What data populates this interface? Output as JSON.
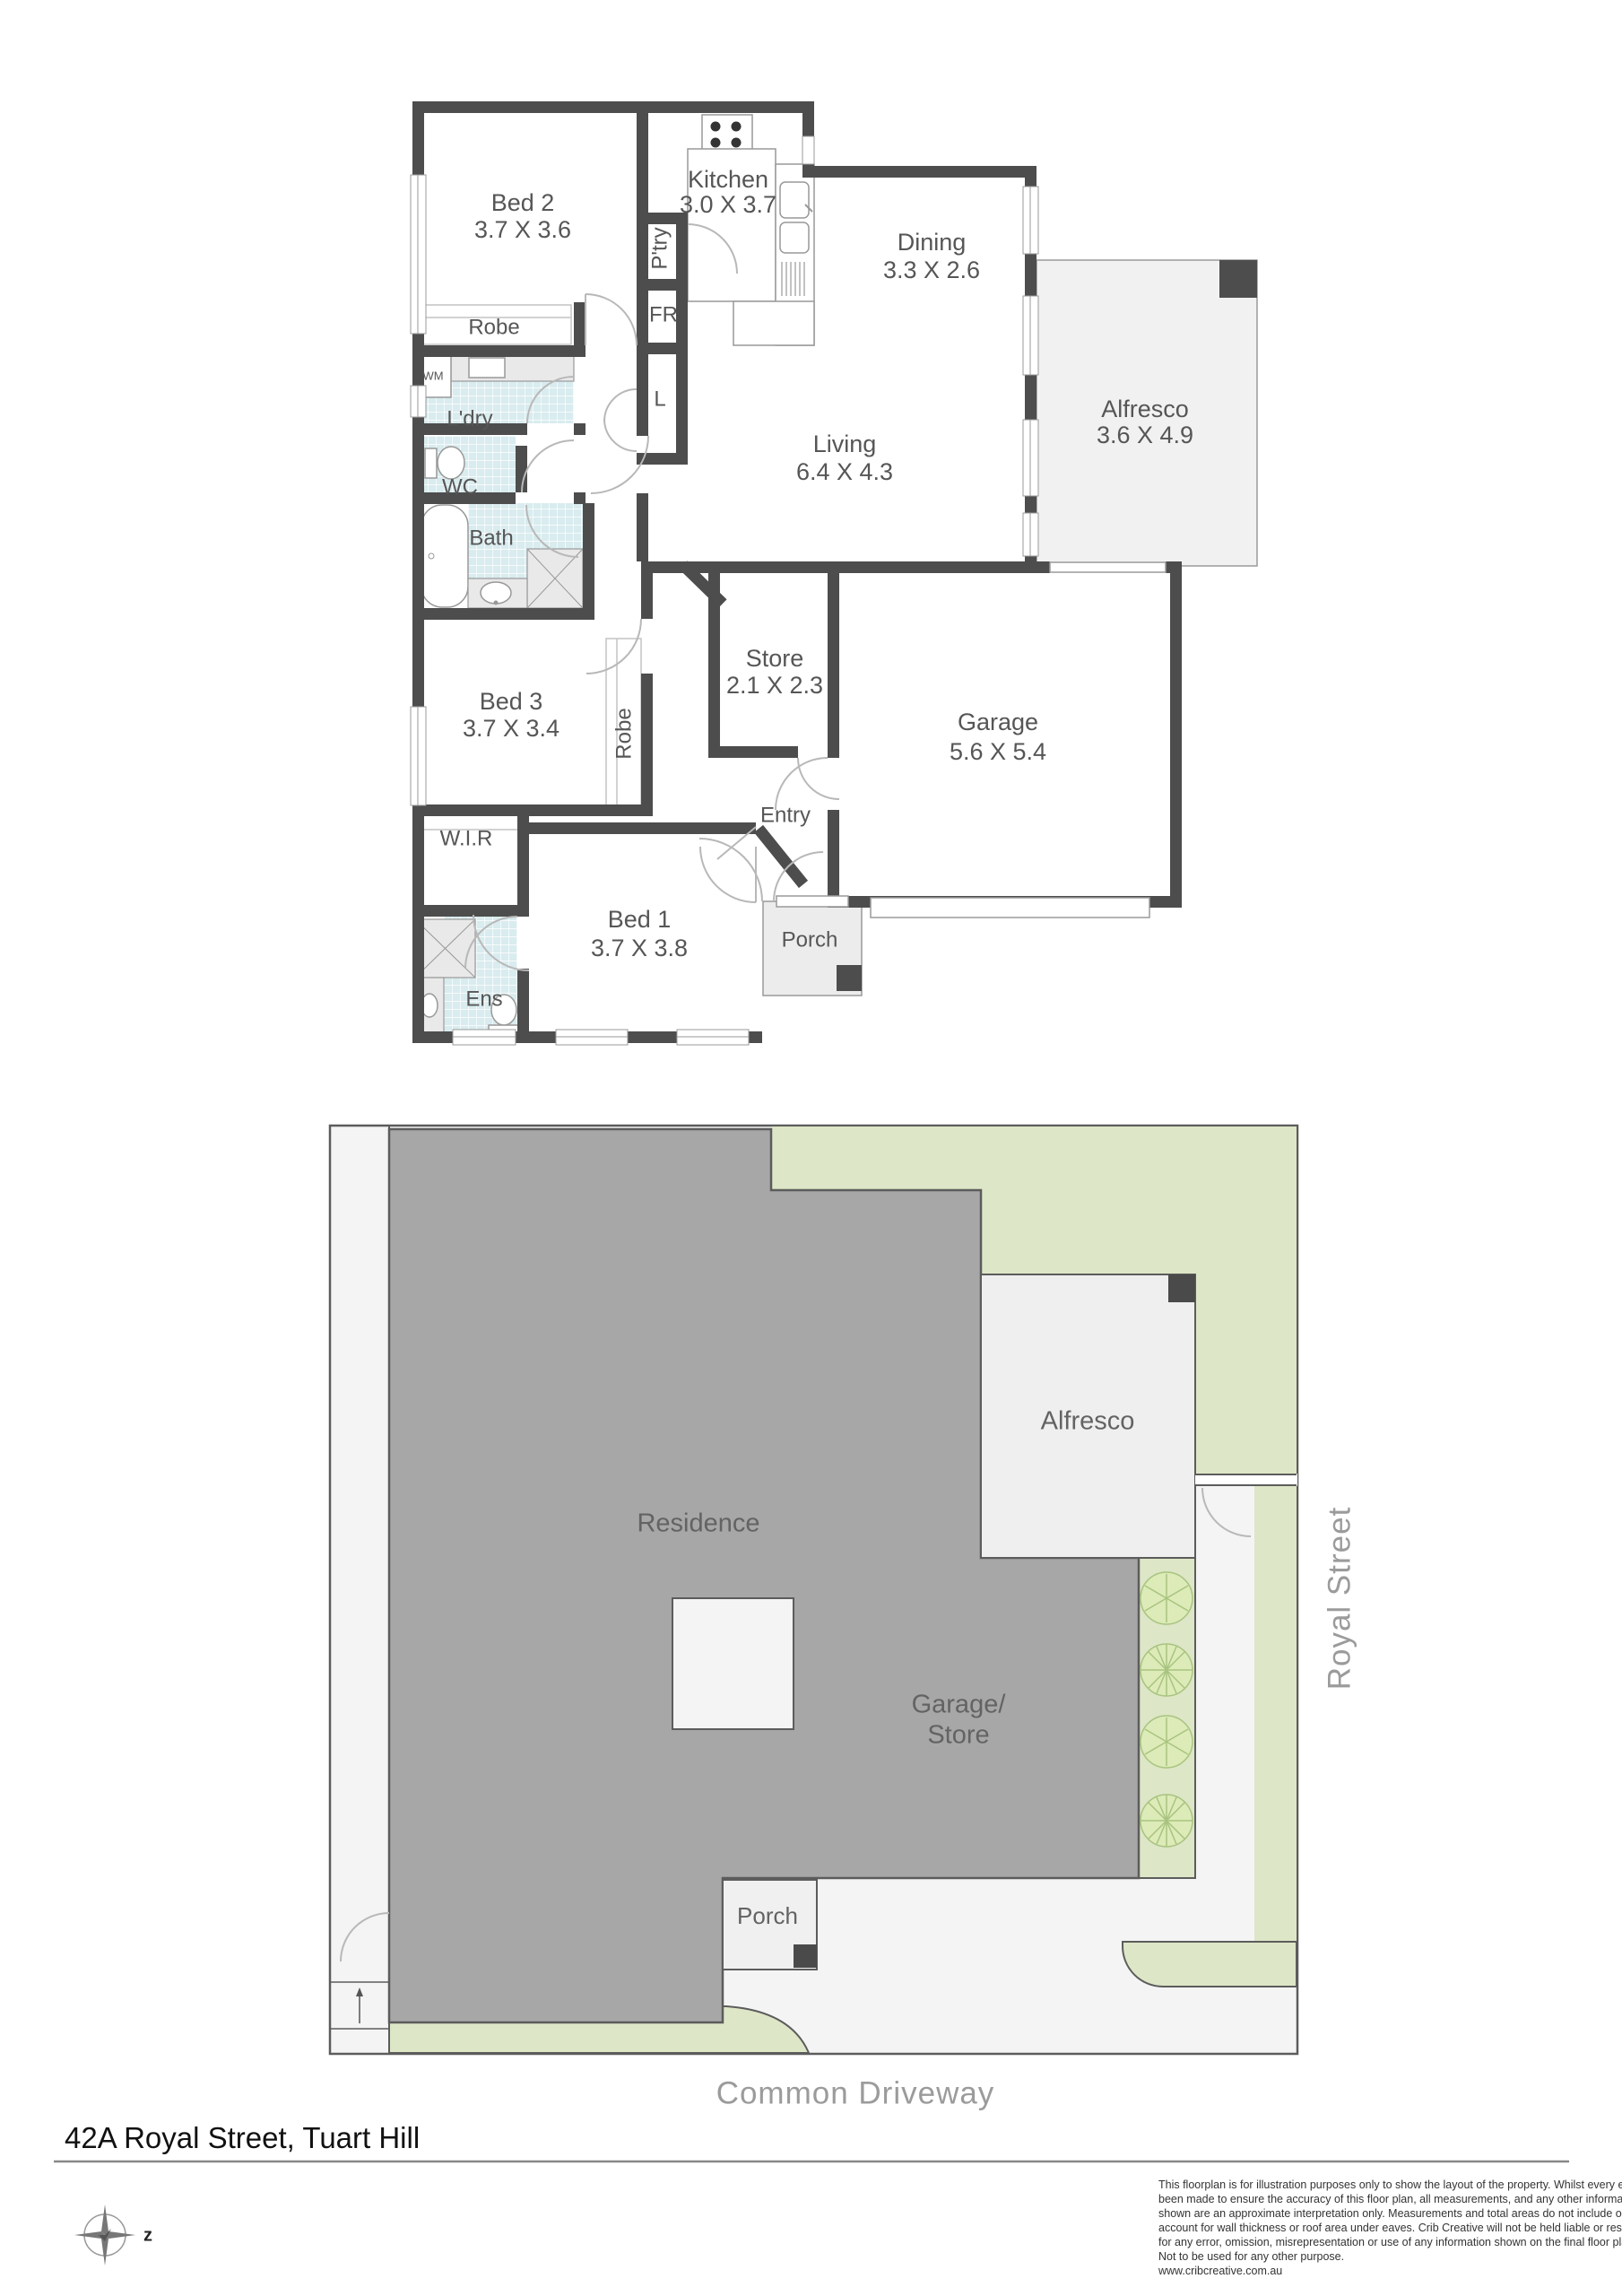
{
  "floorplan": {
    "rooms": {
      "bed2": {
        "name": "Bed 2",
        "dims": "3.7 X 3.6"
      },
      "kitchen": {
        "name": "Kitchen",
        "dims": "3.0 X 3.7"
      },
      "dining": {
        "name": "Dining",
        "dims": "3.3 X 2.6"
      },
      "alfresco": {
        "name": "Alfresco",
        "dims": "3.6 X 4.9"
      },
      "living": {
        "name": "Living",
        "dims": "6.4 X 4.3"
      },
      "bed3": {
        "name": "Bed 3",
        "dims": "3.7 X 3.4"
      },
      "store": {
        "name": "Store",
        "dims": "2.1 X 2.3"
      },
      "garage": {
        "name": "Garage",
        "dims": "5.6 X 5.4"
      },
      "bed1": {
        "name": "Bed 1",
        "dims": "3.7 X 3.8"
      }
    },
    "labels": {
      "robe_bed2": "Robe",
      "laundry": "L'dry",
      "wm": "WM",
      "wc": "WC",
      "bath": "Bath",
      "pantry": "P'try",
      "fridge": "FR",
      "linen": "L",
      "robe_bed3": "Robe",
      "entry": "Entry",
      "wir": "W.I.R",
      "ens": "Ens",
      "porch": "Porch"
    }
  },
  "siteplan": {
    "residence": "Residence",
    "alfresco": "Alfresco",
    "garage_store": [
      "Garage/",
      "Store"
    ],
    "porch": "Porch",
    "street": "Royal Street",
    "driveway": "Common Driveway",
    "compass_letter": "z"
  },
  "footer": {
    "address": "42A Royal Street, Tuart Hill",
    "disclaimer": [
      "This floorplan is for illustration purposes only to show the layout of the property. Whilst every effort has",
      "been made to ensure the accuracy of this floor plan, all measurements, and any other information",
      "shown are an approximate interpretation only. Measurements and total areas do not include or",
      "account for wall thickness or roof area under eaves. Crib Creative will not be held liable or responsible",
      "for any error, omission, misrepresentation or use of any information shown on the final floor plan.",
      "Not to be used for any other purpose.",
      "www.cribcreative.com.au"
    ]
  },
  "colors": {
    "wall": "#4d4d4d",
    "tile": "#d9ecef",
    "lawn": "#dde6c6",
    "residence_fill": "#a7a7a7",
    "label_text": "#565656",
    "street_text": "#9b9b9b"
  }
}
